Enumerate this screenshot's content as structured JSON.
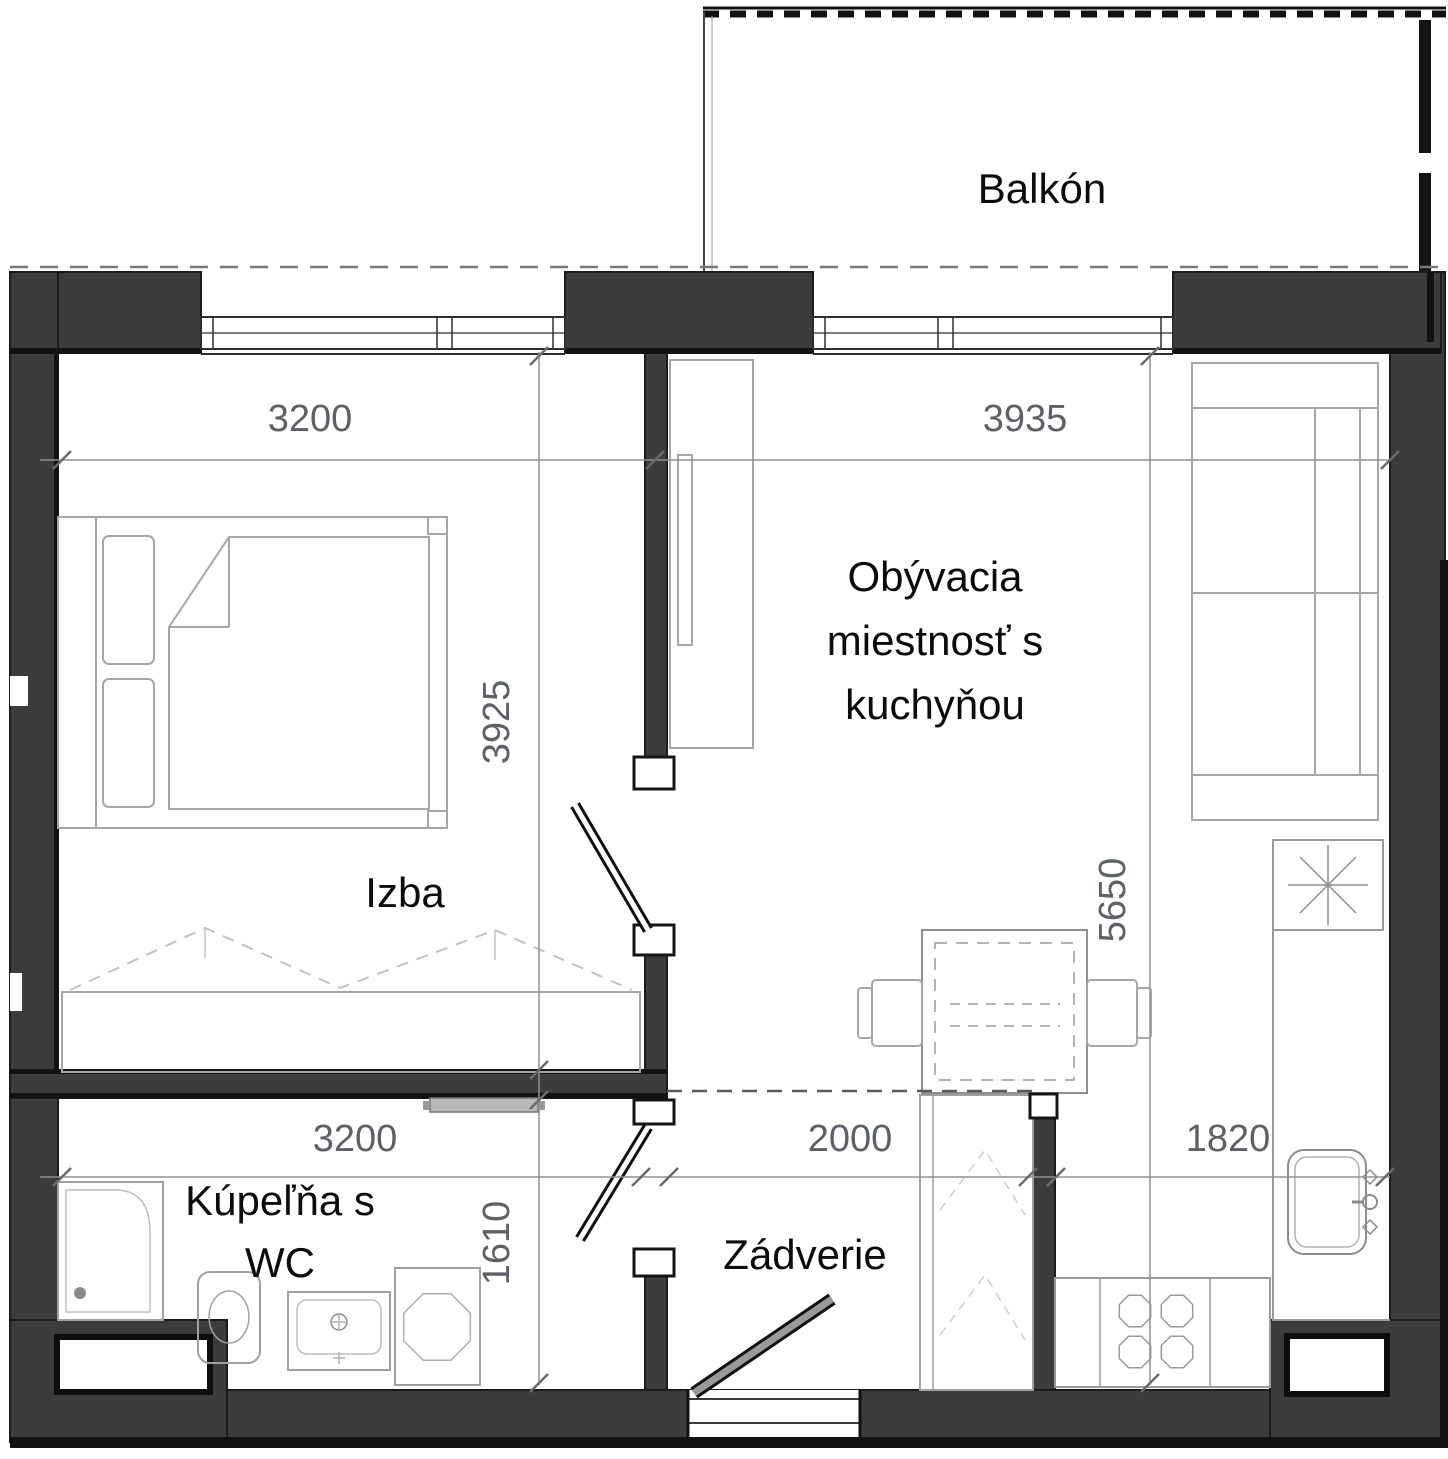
{
  "colors": {
    "wall": "#3c3c3c",
    "line": "#141414",
    "furniture": "#a6a6a6",
    "furniture_light": "#c2c2c2",
    "dim": "#5d6167",
    "label": "#0c0c0c",
    "entry_door": "#999999",
    "background": "#ffffff"
  },
  "rooms": {
    "balcony": {
      "label": "Balkón"
    },
    "bedroom": {
      "label": "Izba"
    },
    "living": {
      "label": "Obývacia miestnosť s kuchyňou",
      "lines": [
        "Obývacia",
        "miestnosť s",
        "kuchyňou"
      ]
    },
    "bathroom": {
      "label": "Kúpeľňa s WC",
      "lines": [
        "Kúpeľňa s",
        "WC"
      ]
    },
    "hall": {
      "label": "Zádverie"
    }
  },
  "dimensions": {
    "width_bedroom_top": "3200",
    "width_living_top": "3935",
    "depth_bedroom": "3925",
    "depth_living": "5650",
    "width_bathroom_bottom": "3200",
    "width_hall_bottom": "2000",
    "width_kitchen_bottom": "1820",
    "depth_bathroom": "1610"
  }
}
